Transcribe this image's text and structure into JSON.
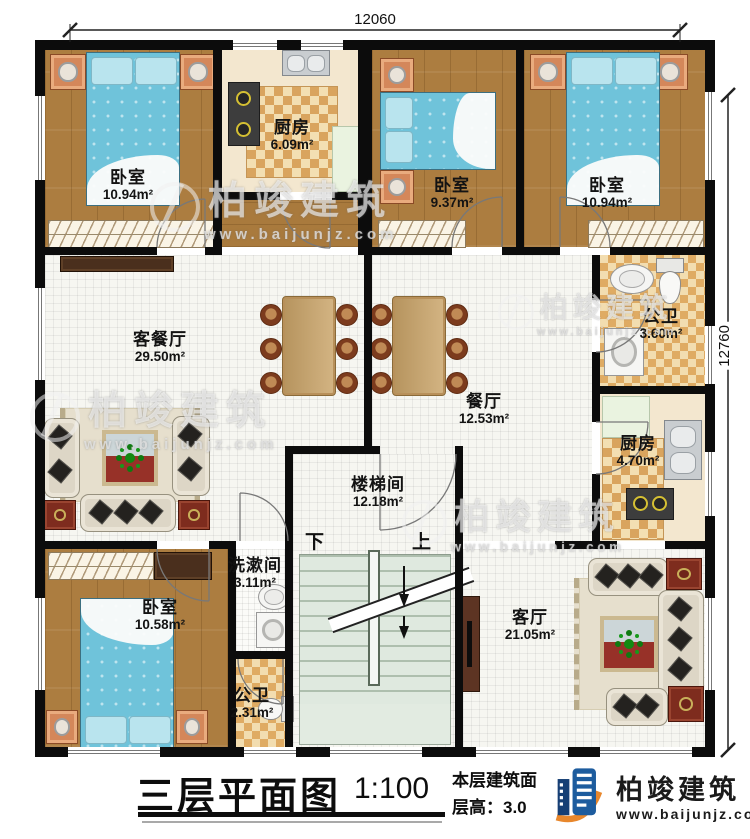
{
  "plan": {
    "dimensions": {
      "top": "12060",
      "right": "12760"
    },
    "rooms": [
      {
        "id": "bedroom-tl",
        "name": "卧室",
        "area": "10.94m²"
      },
      {
        "id": "kitchen-top",
        "name": "厨房",
        "area": "6.09m²"
      },
      {
        "id": "bedroom-tc",
        "name": "卧室",
        "area": "9.37m²"
      },
      {
        "id": "bedroom-tr",
        "name": "卧室",
        "area": "10.94m²"
      },
      {
        "id": "living-dining",
        "name": "客餐厅",
        "area": "29.50m²"
      },
      {
        "id": "dining",
        "name": "餐厅",
        "area": "12.53m²"
      },
      {
        "id": "bath-right",
        "name": "公卫",
        "area": "3.60m²"
      },
      {
        "id": "kitchen-right",
        "name": "厨房",
        "area": "4.70m²"
      },
      {
        "id": "stairwell",
        "name": "楼梯间",
        "area": "12.18m²"
      },
      {
        "id": "washroom",
        "name": "洗漱间",
        "area": "3.11m²"
      },
      {
        "id": "bedroom-bl",
        "name": "卧室",
        "area": "10.58m²"
      },
      {
        "id": "bath-bl",
        "name": "公卫",
        "area": "2.31m²"
      },
      {
        "id": "living-br",
        "name": "客厅",
        "area": "21.05m²"
      }
    ],
    "stairs": {
      "down_label": "下",
      "up_label": "上"
    }
  },
  "title_block": {
    "title": "三层平面图",
    "scale": "1:100",
    "info_line1": "本层建筑面",
    "info_line2": "层高：3.0",
    "brand": "柏竣建筑",
    "website": "www.baijunjz.com",
    "logo_icon": "building-logo-icon"
  },
  "watermark": {
    "brand": "柏竣建筑",
    "website": "www.baijunjz.com"
  },
  "colors": {
    "wall": "#0c0c0c",
    "wood_floor": "#ac7d40",
    "tile": "#dfab63",
    "bed": "#6fc3da",
    "logo_blue": "#1d5c9e",
    "logo_orange": "#e8872c"
  }
}
